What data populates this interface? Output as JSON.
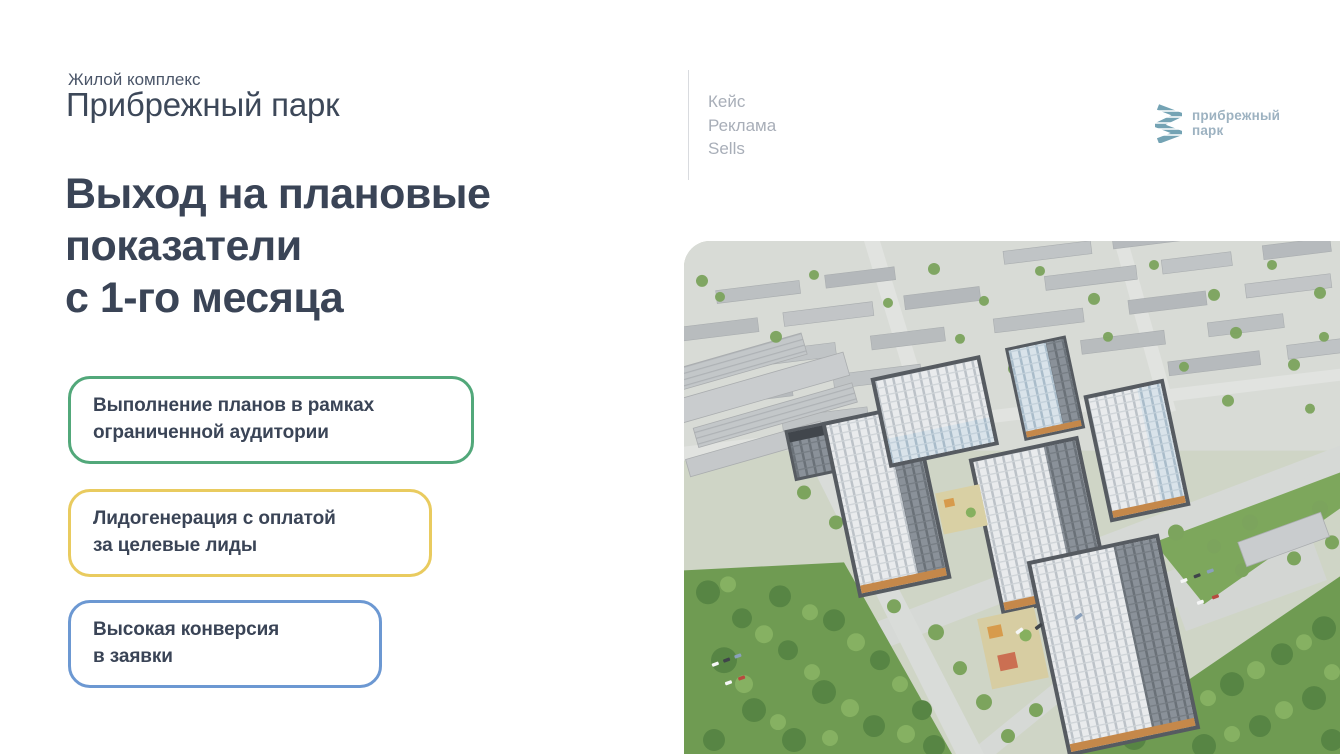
{
  "header": {
    "kicker": "Жилой комплекс",
    "complex_name": "Прибрежный парк",
    "headline": "Выход на плановые\nпоказатели\nс 1-го месяца"
  },
  "meta": {
    "items": [
      "Кейс",
      "Реклама",
      "Sells"
    ]
  },
  "logo": {
    "icon": "zigzag-wave-icon",
    "icon_color": "#74a3b4",
    "text": "прибрежный\nпарк",
    "text_color": "#9db2c1"
  },
  "features": [
    {
      "text": "Выполнение планов в рамках\nограниченной аудитории",
      "border_color": "#52a87a"
    },
    {
      "text": "Лидогенерация с оплатой\nза целевые лиды",
      "border_color": "#e9cb5f"
    },
    {
      "text": "Высокая конверсия\nв заявки",
      "border_color": "#6c98d2"
    }
  ],
  "photo": {
    "description": "аэросъёмка жилого комплекса: новые высотки среди зелёных массивов и городской застройки"
  },
  "colors": {
    "headline_text": "#3a4456",
    "meta_text": "#a8aeb8",
    "background": "#ffffff"
  }
}
